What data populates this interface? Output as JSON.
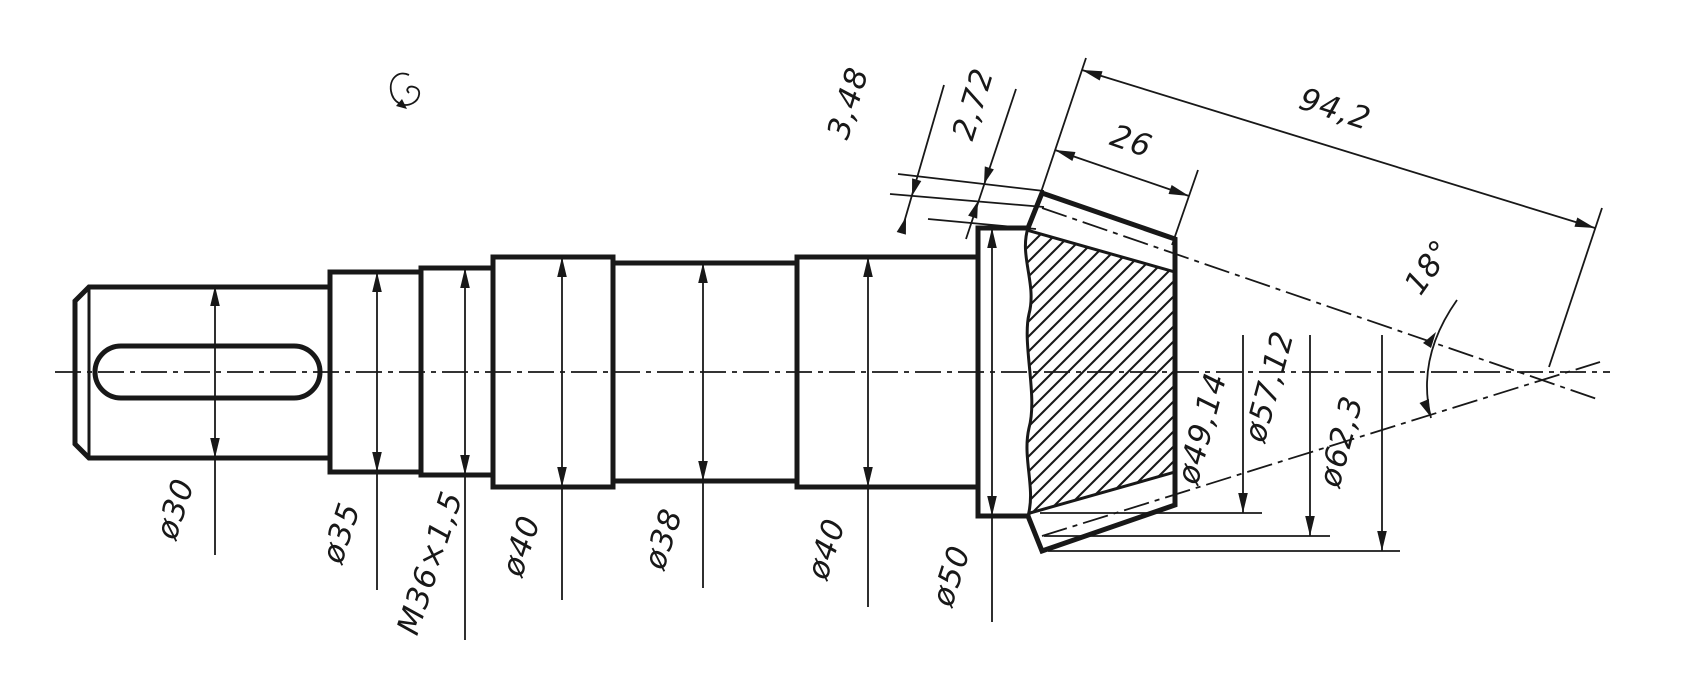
{
  "drawing": {
    "shaft_dims": [
      "ø30",
      "ø35",
      "M36×1,5",
      "ø40",
      "ø38",
      "ø40",
      "ø50"
    ],
    "gear_dims": {
      "dedendum": "3,48",
      "addendum": "2,72",
      "face_width": "26",
      "cone_distance": "94,2",
      "pitch_cone_angle": "18°",
      "root_diameter": "ø49,14",
      "pitch_diameter": "ø57,12",
      "tip_diameter": "ø62,3"
    },
    "colors": {
      "ink": "#181818",
      "paper": "#ffffff"
    }
  }
}
